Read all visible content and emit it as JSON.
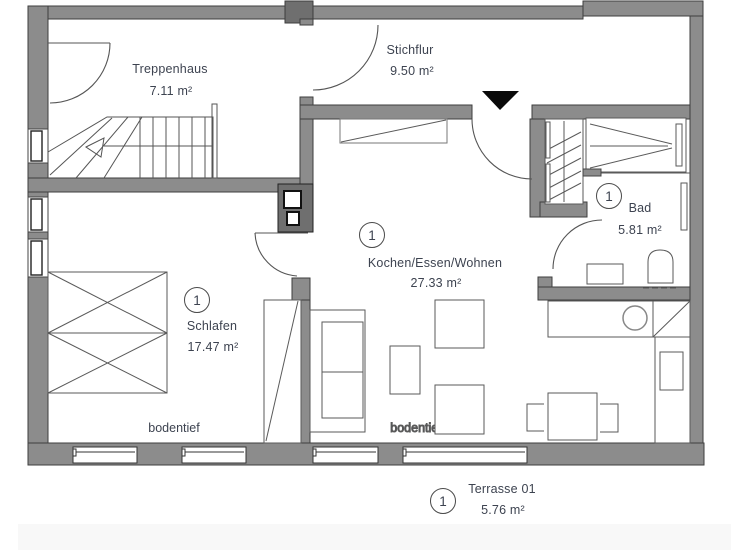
{
  "plan": {
    "rooms": [
      {
        "id": "treppenhaus",
        "name": "Treppenhaus",
        "area": "7.11 m²"
      },
      {
        "id": "stichflur",
        "name": "Stichflur",
        "area": "9.50 m²"
      },
      {
        "id": "bad",
        "number": "1",
        "name": "Bad",
        "area": "5.81 m²"
      },
      {
        "id": "kochen",
        "number": "1",
        "name": "Kochen/Essen/Wohnen",
        "area": "27.33 m²"
      },
      {
        "id": "schlafen",
        "number": "1",
        "name": "Schlafen",
        "area": "17.47 m²"
      },
      {
        "id": "terrasse",
        "number": "1",
        "name": "Terrasse 01",
        "area": "5.76 m²"
      }
    ],
    "annotations": {
      "bodentief_bedroom": "bodentief",
      "bodentief_living": "bodentief"
    },
    "colors": {
      "wall": "#8c8c8c",
      "wall_dark": "#6f6f6f",
      "outline": "#3e3e3e",
      "furniture_line": "#5a5a5a",
      "text": "#3d4350",
      "entrance_marker": "#0a0a0a",
      "terrace_band": "#f8f8f8"
    }
  }
}
